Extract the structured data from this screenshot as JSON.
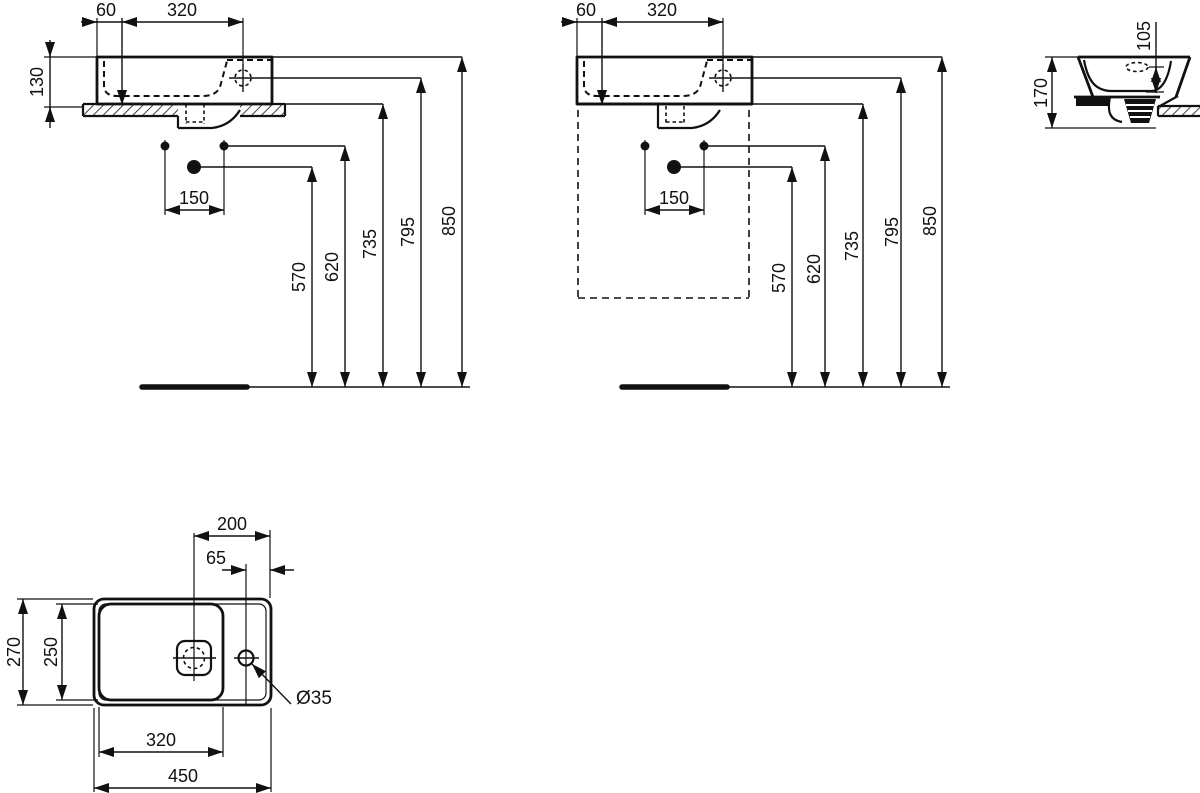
{
  "drawing": {
    "type": "sanitary-ware dimensional drawing (washbasin)",
    "colors": {
      "line": "#111111",
      "background": "#ffffff"
    },
    "views": {
      "front_wall": {
        "dims": {
          "offset": "60",
          "width": "320",
          "height": "130",
          "holes": "150",
          "h570": "570",
          "h620": "620",
          "h735": "735",
          "h795": "795",
          "h850": "850"
        }
      },
      "front_furniture": {
        "dims": {
          "offset": "60",
          "width": "320",
          "holes": "150",
          "h570": "570",
          "h620": "620",
          "h735": "735",
          "h795": "795",
          "h850": "850"
        }
      },
      "side": {
        "dims": {
          "depth": "105",
          "height": "170"
        }
      },
      "plan": {
        "dims": {
          "drain_edge": "200",
          "tap_edge": "65",
          "depth": "270",
          "bowl_depth": "250",
          "bowl_width": "320",
          "width": "450",
          "hole_dia": "Ø35"
        }
      }
    }
  }
}
